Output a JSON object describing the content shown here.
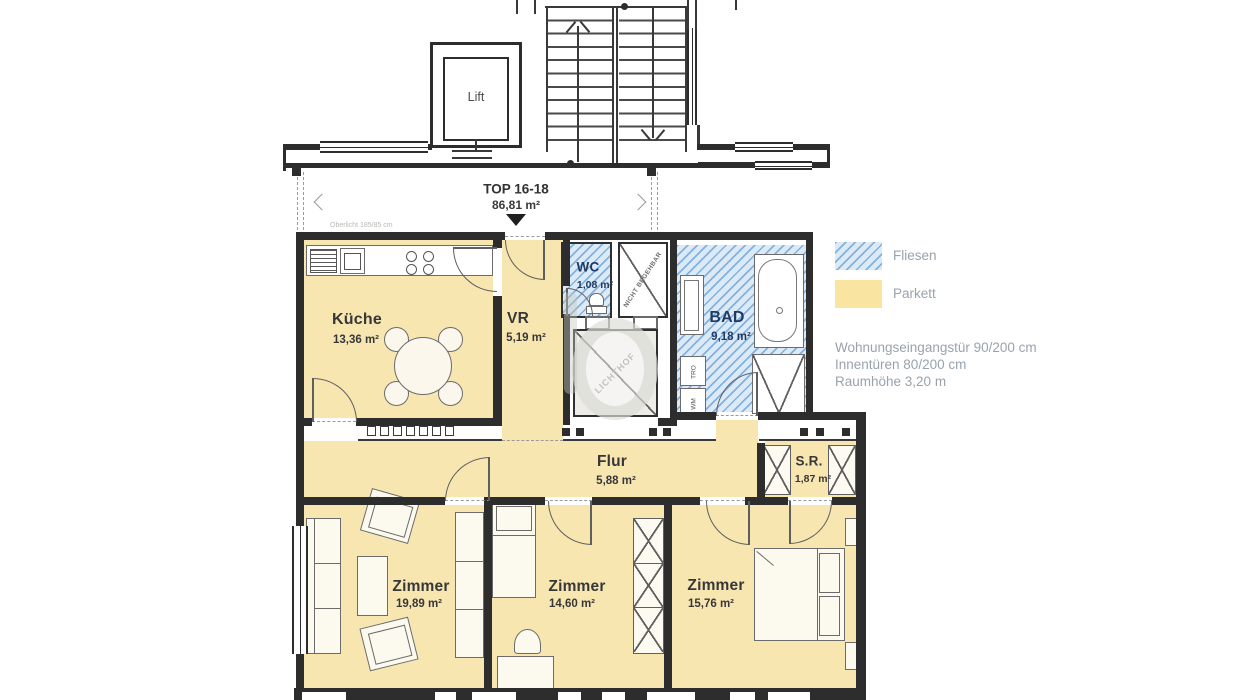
{
  "plan": {
    "building": {
      "lift_label": "Lift"
    },
    "unit": {
      "label": "TOP 16-18",
      "area": "86,81 m²"
    },
    "note_oberlicht": "Oberlicht 185/85 cm",
    "rooms": [
      {
        "name": "Küche",
        "area": "13,36 m²",
        "floor": "parquet"
      },
      {
        "name": "VR",
        "area": "5,19 m²",
        "floor": "parquet"
      },
      {
        "name": "WC",
        "area": "1,08 m²",
        "floor": "tiles"
      },
      {
        "name": "BAD",
        "area": "9,18 m²",
        "floor": "tiles"
      },
      {
        "name": "Flur",
        "area": "5,88 m²",
        "floor": "parquet"
      },
      {
        "name": "S.R.",
        "area": "1,87 m²",
        "floor": "parquet"
      },
      {
        "name": "Zimmer",
        "area": "19,89 m²",
        "floor": "parquet"
      },
      {
        "name": "Zimmer",
        "area": "14,60 m²",
        "floor": "parquet"
      },
      {
        "name": "Zimmer",
        "area": "15,76 m²",
        "floor": "parquet"
      }
    ],
    "annotations": {
      "shaft": "NICHT BEGEHBAR",
      "lichthof": "LICHTHOF",
      "washer": "WM",
      "dryer": "TRO"
    }
  },
  "legend": {
    "items": [
      {
        "label": "Fliesen",
        "swatch": "tiles"
      },
      {
        "label": "Parkett",
        "swatch": "parquet"
      }
    ],
    "notes": [
      "Wohnungseingangstür 90/200 cm",
      "Innentüren 80/200 cm",
      "Raumhöhe 3,20 m"
    ]
  },
  "colors": {
    "parquet": "#F8E6B0",
    "tile_bg": "#DCEAF7",
    "tile_stripe": "#82B1DE",
    "wall": "#2D2D2E",
    "line": "#5F5F5F",
    "label": "#37373A",
    "wet_label": "#1F3A64",
    "legend_text": "#98A3AD"
  }
}
